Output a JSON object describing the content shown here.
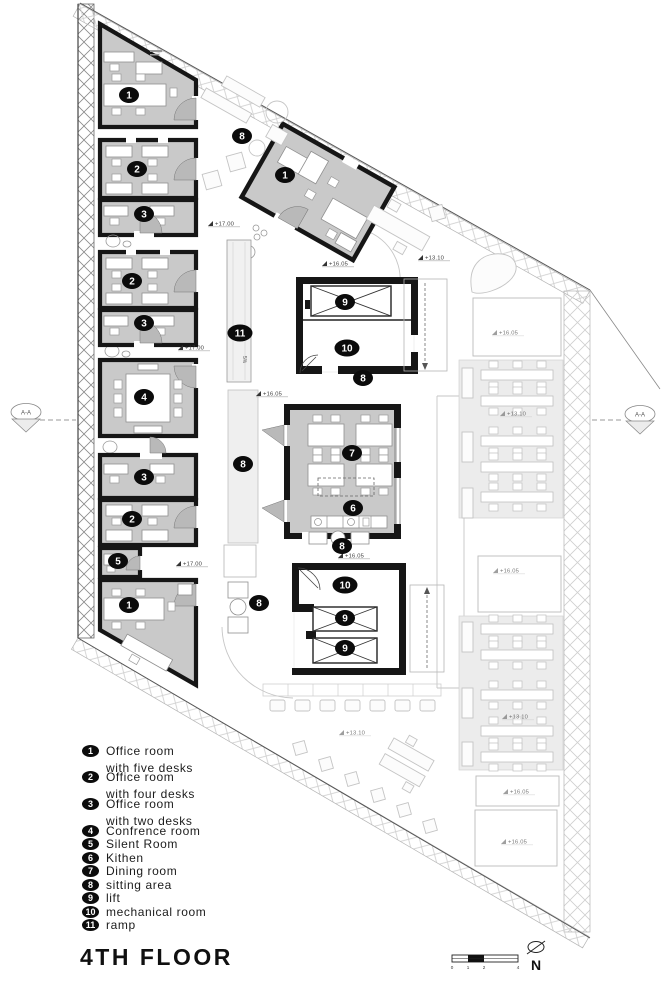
{
  "title": "4TH FLOOR",
  "legend": {
    "items": [
      {
        "num": "1",
        "lines": [
          "Office room",
          "with five desks"
        ]
      },
      {
        "num": "2",
        "lines": [
          "Office room",
          "with four desks"
        ]
      },
      {
        "num": "3",
        "lines": [
          "Office room",
          "with two desks"
        ]
      },
      {
        "num": "4",
        "lines": [
          "Confrence room"
        ]
      },
      {
        "num": "5",
        "lines": [
          "Silent Room"
        ]
      },
      {
        "num": "6",
        "lines": [
          "Kithen"
        ]
      },
      {
        "num": "7",
        "lines": [
          "Dining room"
        ]
      },
      {
        "num": "8",
        "lines": [
          "sitting area"
        ]
      },
      {
        "num": "9",
        "lines": [
          "lift"
        ]
      },
      {
        "num": "10",
        "lines": [
          "mechanical room"
        ]
      },
      {
        "num": "11",
        "lines": [
          "ramp"
        ]
      }
    ]
  },
  "plan": {
    "badges": [
      "1",
      "2",
      "3",
      "2",
      "3",
      "4",
      "3",
      "2",
      "5",
      "1",
      "1",
      "8",
      "11",
      "9",
      "10",
      "8",
      "8",
      "7",
      "6",
      "8",
      "10",
      "9",
      "9",
      "8"
    ],
    "levels": [
      "+17.00",
      "+16.05",
      "+13.10",
      "+16.05",
      "+17.00",
      "+17.00",
      "+16.05",
      "+13.10",
      "+16.05",
      "+13.10",
      "+16.05",
      "+13.10",
      "+16.05",
      "+16.05"
    ],
    "ramp_note": "5%",
    "section_label": "A-A",
    "north_label": "N",
    "scale_ticks": [
      "0",
      "1",
      "2",
      "4"
    ]
  },
  "colors": {
    "wall": "#161616",
    "room_fill": "#c9c9c9",
    "ghost": "#c6c6c6",
    "panel_fill": "#ececec",
    "paper": "#ffffff"
  }
}
